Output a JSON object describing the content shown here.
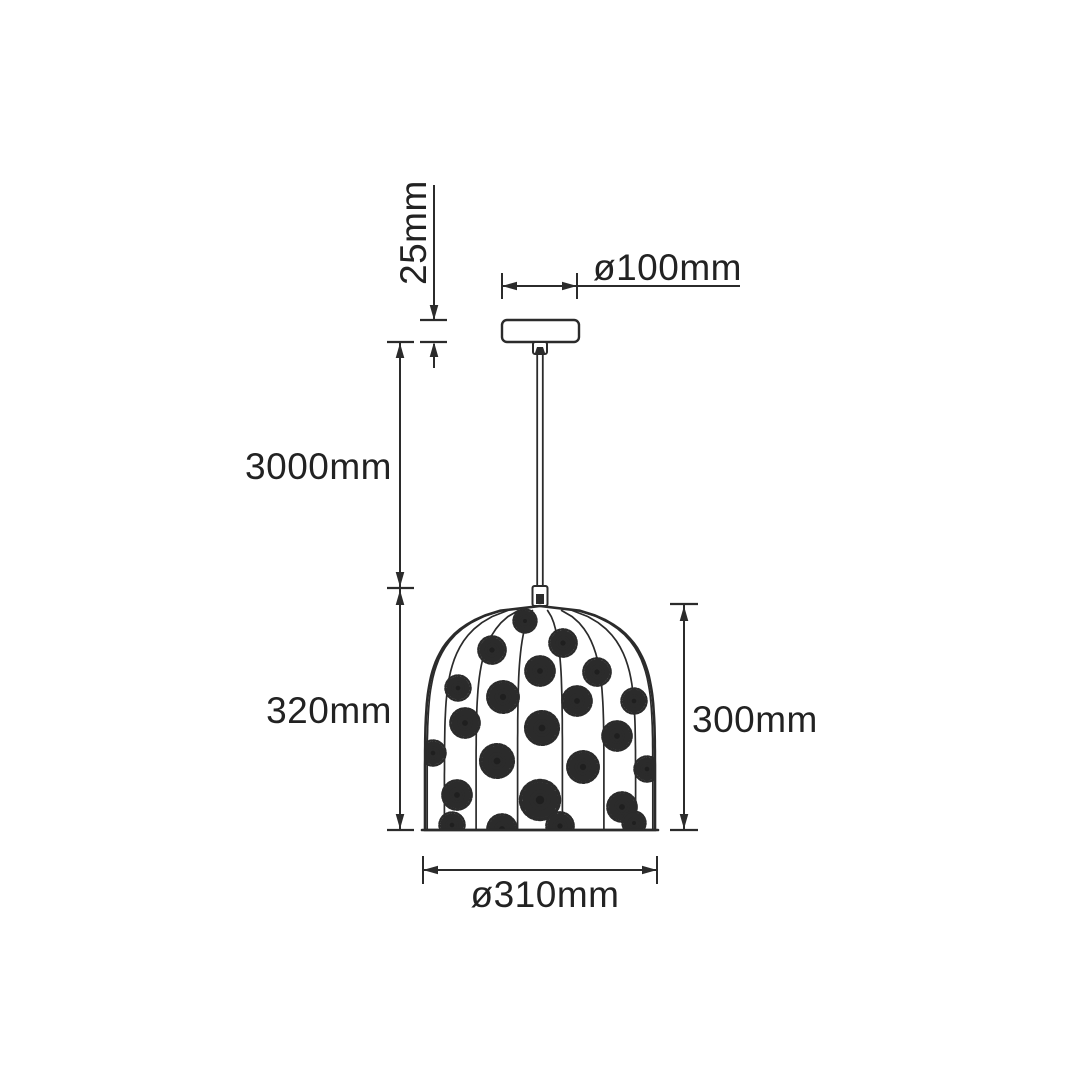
{
  "diagram": {
    "background": "#ffffff",
    "line_color": "#2b2b2b",
    "labels": {
      "canopy_height": "25mm",
      "canopy_diameter": "ø100mm",
      "suspension_length": "3000mm",
      "shade_height_left": "320mm",
      "shade_height_right": "300mm",
      "shade_diameter": "ø310mm"
    }
  }
}
